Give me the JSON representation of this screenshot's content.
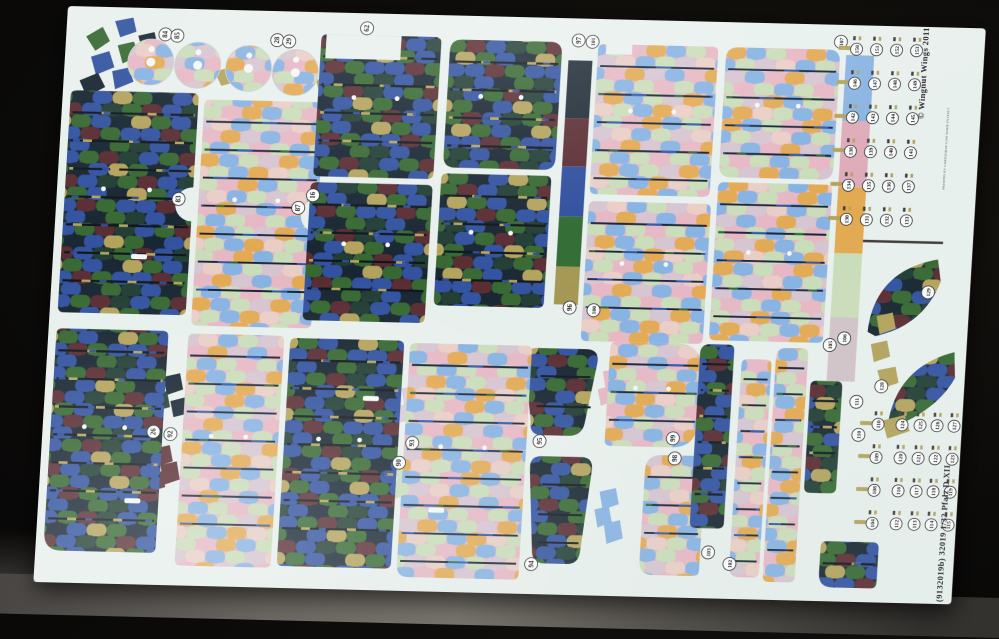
{
  "photo": {
    "subject": "WWI five-colour lozenge camouflage waterslide decal sheet photographed on a dark surface",
    "copyright": "© Wingnut Wings 2011",
    "printer_note": "PRINTED BY CARTOGRAF.COM    MADE IN ITALY",
    "sheet_id": "(9132019b)   32019   1/32   Pfalz D.XII"
  },
  "palette": {
    "sheet": "#e8f0ed",
    "background": "#0b0a09",
    "table_surface": "#6b6761",
    "dark_lozenge": [
      "#2e4f9e",
      "#33652e",
      "#13222e",
      "#56282e",
      "#b2a159",
      "#1d3a30"
    ],
    "light_lozenge": [
      "#84b1e2",
      "#e6b6c3",
      "#c9dcb8",
      "#e2a84f",
      "#d5c4d0",
      "#e9cdc5"
    ],
    "dark_color_strip": [
      "#1a2631",
      "#56282e",
      "#2b4a9b",
      "#2e682f",
      "#a2954f"
    ],
    "pastel_color_strip": [
      "#88b3e1",
      "#deaab8",
      "#e2a84f",
      "#c9dcb8",
      "#cfc2c8"
    ]
  },
  "panels": [
    {
      "id": "wing-panel-a-dark",
      "kind": "dark",
      "x": 8,
      "y": 84,
      "w": 128,
      "h": 222,
      "notch": "right"
    },
    {
      "id": "wing-panel-a-light",
      "kind": "light",
      "x": 142,
      "y": 90,
      "w": 120,
      "h": 226,
      "notch": "right"
    },
    {
      "id": "fuselage-panel-1-dark",
      "kind": "dark",
      "x": 255,
      "y": 22,
      "w": 120,
      "h": 142,
      "cut": [
        5,
        0,
        75,
        24
      ]
    },
    {
      "id": "fuselage-panel-2-dark",
      "kind": "dark",
      "x": 253,
      "y": 170,
      "w": 122,
      "h": 138
    },
    {
      "id": "fuselage-panel-3-dark",
      "kind": "dark",
      "x": 384,
      "y": 24,
      "w": 112,
      "h": 128,
      "rx": 12
    },
    {
      "id": "fuselage-panel-4-dark",
      "kind": "dark",
      "x": 383,
      "y": 158,
      "w": 110,
      "h": 132
    },
    {
      "id": "wing-panel-b-light",
      "kind": "light",
      "x": 532,
      "y": 25,
      "w": 120,
      "h": 150,
      "cut": [
        8,
        0,
        26,
        10
      ]
    },
    {
      "id": "wing-panel-c-light",
      "kind": "light",
      "x": 532,
      "y": 182,
      "w": 122,
      "h": 140
    },
    {
      "id": "wing-panel-d-light",
      "kind": "light",
      "x": 660,
      "y": 25,
      "w": 114,
      "h": 130,
      "rx": 12
    },
    {
      "id": "wing-panel-e-light",
      "kind": "light",
      "x": 660,
      "y": 160,
      "w": 114,
      "h": 158
    },
    {
      "id": "lower-wing-dark",
      "kind": "dark",
      "x": 8,
      "y": 322,
      "w": 112,
      "h": 222,
      "rxbl": 18
    },
    {
      "id": "lower-wing-light",
      "kind": "light",
      "x": 140,
      "y": 324,
      "w": 96,
      "h": 232
    },
    {
      "id": "lower-mid-dark",
      "kind": "dark",
      "x": 242,
      "y": 326,
      "w": 114,
      "h": 228
    },
    {
      "id": "lower-mid-light",
      "kind": "light",
      "x": 362,
      "y": 328,
      "w": 122,
      "h": 234,
      "rxbl": 12
    },
    {
      "id": "tailplane-upper-light",
      "kind": "light",
      "x": 562,
      "y": 322,
      "w": 92,
      "h": 104,
      "rxr": 26
    },
    {
      "id": "tailplane-lower-light",
      "kind": "light",
      "x": 604,
      "y": 434,
      "w": 60,
      "h": 120,
      "rxtl": 16,
      "rxbl": 14
    },
    {
      "id": "strip-a-dark",
      "kind": "dark",
      "x": 652,
      "y": 322,
      "w": 34,
      "h": 184,
      "rxtl": 10
    },
    {
      "id": "strip-b-light",
      "kind": "light",
      "x": 694,
      "y": 336,
      "w": 30,
      "h": 218,
      "rxbl": 10
    },
    {
      "id": "strip-c-light",
      "kind": "light",
      "x": 728,
      "y": 324,
      "w": 32,
      "h": 234,
      "rxtl": 10
    },
    {
      "id": "strip-d-dark",
      "kind": "dark",
      "x": 764,
      "y": 356,
      "w": 32,
      "h": 112
    },
    {
      "id": "strip-e-dark",
      "kind": "dark",
      "x": 784,
      "y": 516,
      "w": 58,
      "h": 46,
      "rxbl": 14
    }
  ],
  "color_strips": [
    {
      "id": "dark-color-chip-strip",
      "x": 503,
      "y": 42,
      "w": 24,
      "blocks": [
        [
          "#1a2631",
          58
        ],
        [
          "#56282e",
          48
        ],
        [
          "#2b4a9b",
          50
        ],
        [
          "#2e682f",
          50
        ],
        [
          "#a2954f",
          38
        ]
      ]
    },
    {
      "id": "pastel-color-chip-strip",
      "x": 780,
      "y": 30,
      "w": 28,
      "blocks": [
        [
          "#88b3e1",
          66
        ],
        [
          "#deaab8",
          66
        ],
        [
          "#e2a84f",
          66
        ],
        [
          "#c9dcb8",
          64
        ],
        [
          "#cfc2c8",
          64
        ]
      ]
    }
  ],
  "wheels": {
    "radius": 23,
    "discs": [
      {
        "cx": 86,
        "cy": 54
      },
      {
        "cx": 133,
        "cy": 56
      },
      {
        "cx": 184,
        "cy": 58
      },
      {
        "cx": 231,
        "cy": 61
      }
    ]
  },
  "part_labels": [
    {
      "t": "84",
      "x": 99,
      "y": 26
    },
    {
      "t": "85",
      "x": 111,
      "y": 27
    },
    {
      "t": "28",
      "x": 211,
      "y": 29
    },
    {
      "t": "29",
      "x": 223,
      "y": 30
    },
    {
      "t": "62",
      "x": 300,
      "y": 15
    },
    {
      "t": "97",
      "x": 512,
      "y": 22
    },
    {
      "t": "101",
      "x": 526,
      "y": 23
    },
    {
      "t": "96",
      "x": 519,
      "y": 289
    },
    {
      "t": "100",
      "x": 543,
      "y": 291
    },
    {
      "t": "107",
      "x": 774,
      "y": 17
    },
    {
      "t": "83",
      "x": 122,
      "y": 190
    },
    {
      "t": "87",
      "x": 242,
      "y": 196
    },
    {
      "t": "16",
      "x": 256,
      "y": 183
    },
    {
      "t": "26",
      "x": 111,
      "y": 423
    },
    {
      "t": "92",
      "x": 128,
      "y": 425
    },
    {
      "t": "93",
      "x": 370,
      "y": 428
    },
    {
      "t": "90",
      "x": 358,
      "y": 448
    },
    {
      "t": "95",
      "x": 497,
      "y": 423
    },
    {
      "t": "94",
      "x": 496,
      "y": 546
    },
    {
      "t": "99",
      "x": 630,
      "y": 417
    },
    {
      "t": "98",
      "x": 633,
      "y": 437
    },
    {
      "t": "103",
      "x": 672,
      "y": 530
    },
    {
      "t": "102",
      "x": 694,
      "y": 541
    },
    {
      "t": "105",
      "x": 781,
      "y": 320
    },
    {
      "t": "106",
      "x": 795,
      "y": 313
    },
    {
      "t": "111",
      "x": 811,
      "y": 376
    },
    {
      "t": "110",
      "x": 815,
      "y": 409
    },
    {
      "t": "129",
      "x": 876,
      "y": 265
    },
    {
      "t": "128",
      "x": 835,
      "y": 360
    }
  ],
  "decal_grid": {
    "top_block": {
      "y_start": 24,
      "row_gap": 34,
      "cols": [
        790,
        810,
        830,
        850
      ],
      "rows": [
        [
          "150",
          "151",
          "152",
          "153"
        ],
        [
          "146",
          "147",
          "148",
          "149"
        ],
        [
          "142",
          "143",
          "144",
          "145"
        ],
        [
          "138",
          "139",
          "140",
          "141"
        ],
        [
          "134",
          "135",
          "136",
          "137"
        ],
        [
          "130",
          "131",
          "132",
          "133"
        ]
      ]
    },
    "bottom_block": {
      "y_start": 398,
      "row_gap": 33,
      "cols": [
        834,
        858,
        876,
        893,
        910
      ],
      "rows": [
        [
          "110",
          "124",
          "125",
          "126",
          "127"
        ],
        [
          "109",
          "120",
          "121",
          "122",
          "123"
        ],
        [
          "108",
          "116",
          "117",
          "118",
          "119"
        ],
        [
          "104",
          "112",
          "113",
          "114",
          "115"
        ]
      ]
    }
  }
}
